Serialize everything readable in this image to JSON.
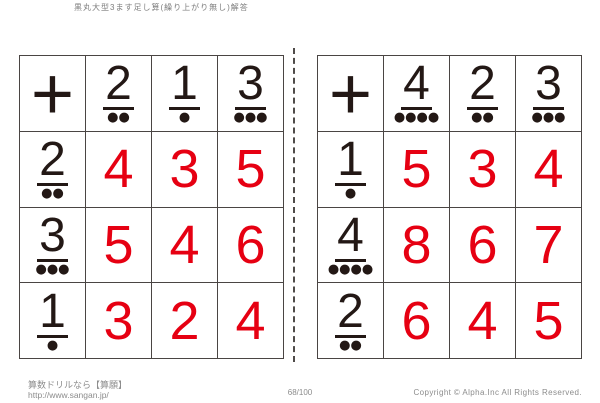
{
  "page": {
    "title": "黒丸大型3ます足し算(繰り上がり無し)解答"
  },
  "footer": {
    "site_name": "算数ドリルなら【算願】",
    "site_url": "http://www.sangan.jp/",
    "page_number": "68/100",
    "copyright": "Copyright © Alpha.Inc All Rights Reserved."
  },
  "colors": {
    "answer_red": "#e60012",
    "ink_black": "#231815",
    "grid_line": "#4a4543",
    "footer_gray": "#8c8c8c"
  },
  "grids": [
    {
      "operator": "+",
      "col_headers": [
        {
          "digit": "2",
          "dots": "●●"
        },
        {
          "digit": "1",
          "dots": "●"
        },
        {
          "digit": "3",
          "dots": "●●●"
        }
      ],
      "rows": [
        {
          "header": {
            "digit": "2",
            "dots": "●●"
          },
          "answers": [
            "4",
            "3",
            "5"
          ]
        },
        {
          "header": {
            "digit": "3",
            "dots": "●●●"
          },
          "answers": [
            "5",
            "4",
            "6"
          ]
        },
        {
          "header": {
            "digit": "1",
            "dots": "●"
          },
          "answers": [
            "3",
            "2",
            "4"
          ]
        }
      ]
    },
    {
      "operator": "+",
      "col_headers": [
        {
          "digit": "4",
          "dots": "●●●●"
        },
        {
          "digit": "2",
          "dots": "●●"
        },
        {
          "digit": "3",
          "dots": "●●●"
        }
      ],
      "rows": [
        {
          "header": {
            "digit": "1",
            "dots": "●"
          },
          "answers": [
            "5",
            "3",
            "4"
          ]
        },
        {
          "header": {
            "digit": "4",
            "dots": "●●●●"
          },
          "answers": [
            "8",
            "6",
            "7"
          ]
        },
        {
          "header": {
            "digit": "2",
            "dots": "●●"
          },
          "answers": [
            "6",
            "4",
            "5"
          ]
        }
      ]
    }
  ]
}
